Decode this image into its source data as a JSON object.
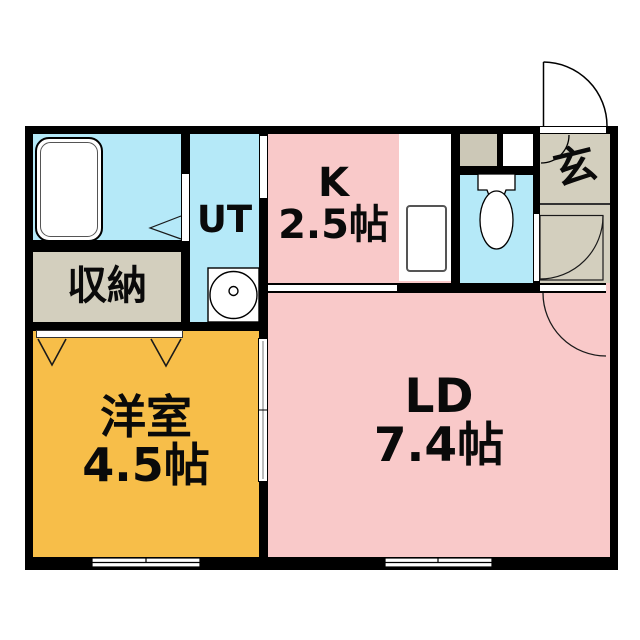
{
  "floor_plan": {
    "rooms": {
      "kitchen": {
        "label": "K",
        "size": "2.5帖"
      },
      "living_dining": {
        "label": "LD",
        "size": "7.4帖"
      },
      "western_room": {
        "label": "洋室",
        "size": "4.5帖"
      },
      "utility": {
        "label": "UT"
      },
      "storage": {
        "label": "収納"
      },
      "entrance": {
        "label": "玄"
      }
    },
    "fixtures": [
      "bathtub",
      "washing-machine-pan",
      "toilet",
      "kitchen-sink"
    ],
    "door_symbols": [
      "entrance-swing-door",
      "hall-swing-door",
      "ld-swing-door",
      "bathroom-folding-door",
      "closet-bifold-doors",
      "sliding-door",
      "windows"
    ],
    "colors": {
      "room_pink": "#f9c9c9",
      "room_blue": "#b5e9f8",
      "room_beige": "#d3cfbe",
      "room_orange": "#f7be49",
      "shaft_gray": "#ccc8b7",
      "wall": "#000000",
      "background": "#ffffff"
    }
  }
}
